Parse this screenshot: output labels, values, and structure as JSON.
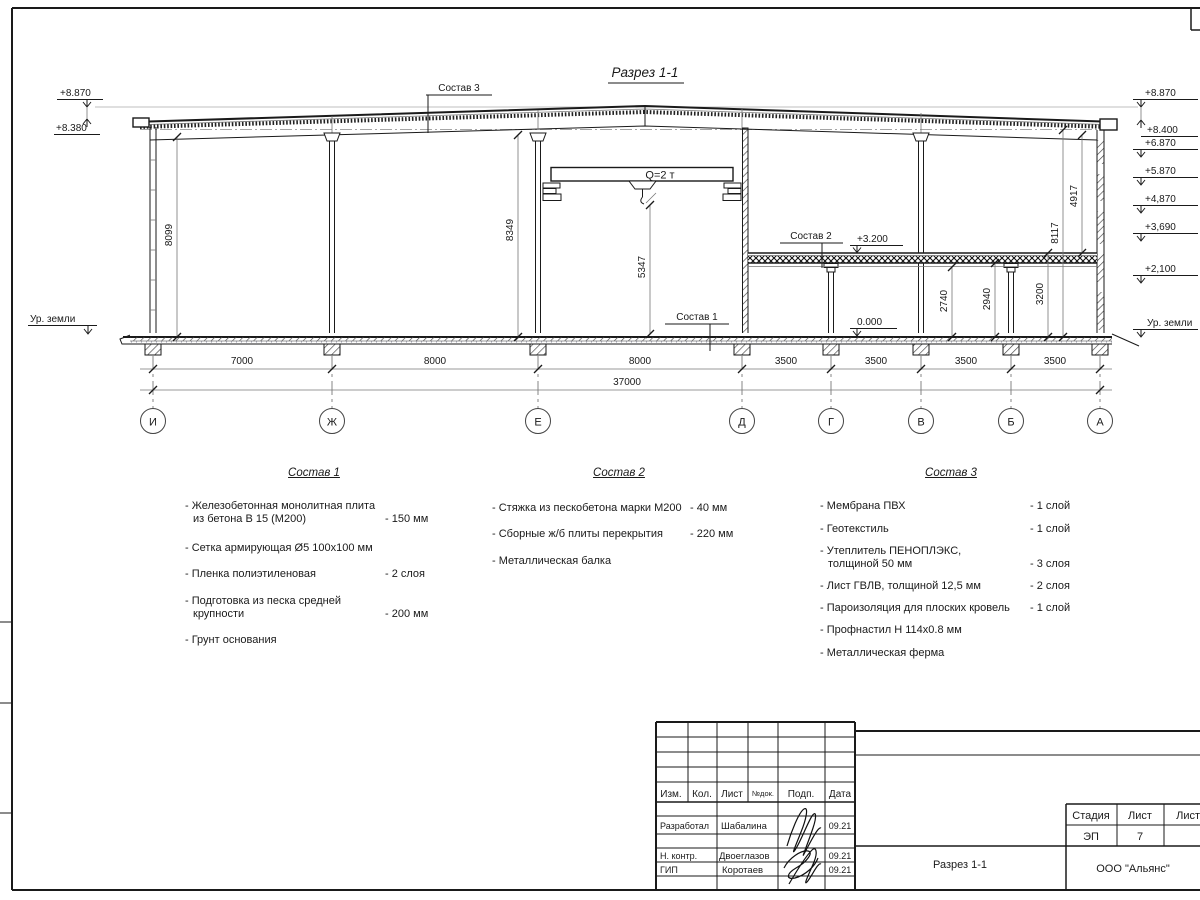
{
  "drawing": {
    "title": "Разрез 1-1",
    "crane": "Q=2 т",
    "callout1": "Состав 1",
    "callout2": "Состав 2",
    "callout3": "Состав 3",
    "mark_mezz": "+3.200",
    "mark_floor": "0.000",
    "elev_left": {
      "top": "+8.870",
      "parapet": "+8.380",
      "ground": "Ур. земли"
    },
    "elev_right": [
      "+8.870",
      "+8.400",
      "+6.870",
      "+5.870",
      "+4,870",
      "+3,690",
      "+2,100",
      "Ур. земли"
    ],
    "dims": {
      "hall_left": "8099",
      "hall_mid": "8349",
      "crane_hook": "5347",
      "under_beam": "2740",
      "under_slab": "2940",
      "slab_top": "3200",
      "wall_full": "8117",
      "upper_part": "4917",
      "spans": [
        "7000",
        "8000",
        "8000",
        "3500",
        "3500",
        "3500",
        "3500"
      ],
      "total": "37000"
    },
    "axes": [
      "И",
      "Ж",
      "Е",
      "Д",
      "Г",
      "В",
      "Б",
      "А"
    ]
  },
  "sostav1": {
    "title": "Состав 1",
    "items": [
      {
        "name": "- Железобетонная  монолитная плита\nиз бетона В 15 (М200)",
        "value": "- 150 мм"
      },
      {
        "name": "- Сетка армирующая Ø5 100х100 мм",
        "value": ""
      },
      {
        "name": "- Пленка полиэтиленовая",
        "value": "-  2 слоя"
      },
      {
        "name": "- Подготовка из песка средней\nкрупности",
        "value": "- 200 мм"
      },
      {
        "name": "- Грунт основания",
        "value": ""
      }
    ]
  },
  "sostav2": {
    "title": "Состав 2",
    "items": [
      {
        "name": "- Стяжка из пескобетона марки М200",
        "value": "- 40 мм"
      },
      {
        "name": "- Сборные ж/б плиты перекрытия",
        "value": "- 220 мм"
      },
      {
        "name": "- Металлическая балка",
        "value": ""
      }
    ]
  },
  "sostav3": {
    "title": "Состав 3",
    "items": [
      {
        "name": "- Мембрана ПВХ",
        "value": "- 1 слой"
      },
      {
        "name": "- Геотекстиль",
        "value": "- 1 слой"
      },
      {
        "name": "- Утеплитель ПЕНОПЛЭКС,\nтолщиной 50 мм",
        "value": "- 3 слоя"
      },
      {
        "name": "- Лист ГВЛВ, толщиной 12,5 мм",
        "value": "- 2 слоя"
      },
      {
        "name": "- Пароизоляция для плоских кровель",
        "value": "- 1 слой"
      },
      {
        "name": "- Профнастил Н 114х0.8 мм",
        "value": ""
      },
      {
        "name": "- Металлическая ферма",
        "value": ""
      }
    ]
  },
  "titleblock": {
    "header": [
      "Изм.",
      "Кол.",
      "Лист",
      "№док.",
      "Подп.",
      "Дата"
    ],
    "rows": [
      {
        "role": "Разработал",
        "name": "Шабалина",
        "date": "09.21"
      },
      {
        "role": "Н. контр.",
        "name": "Двоеглазов",
        "date": "09.21"
      },
      {
        "role": "ГИП",
        "name": "Коротаев",
        "date": "09.21"
      }
    ],
    "stage_label": "Стадия",
    "sheet_label": "Лист",
    "sheets_label": "Листов",
    "stage": "ЭП",
    "sheet_no": "7",
    "doc_title": "Разрез 1-1",
    "company": "ООО \"Альянс\""
  }
}
